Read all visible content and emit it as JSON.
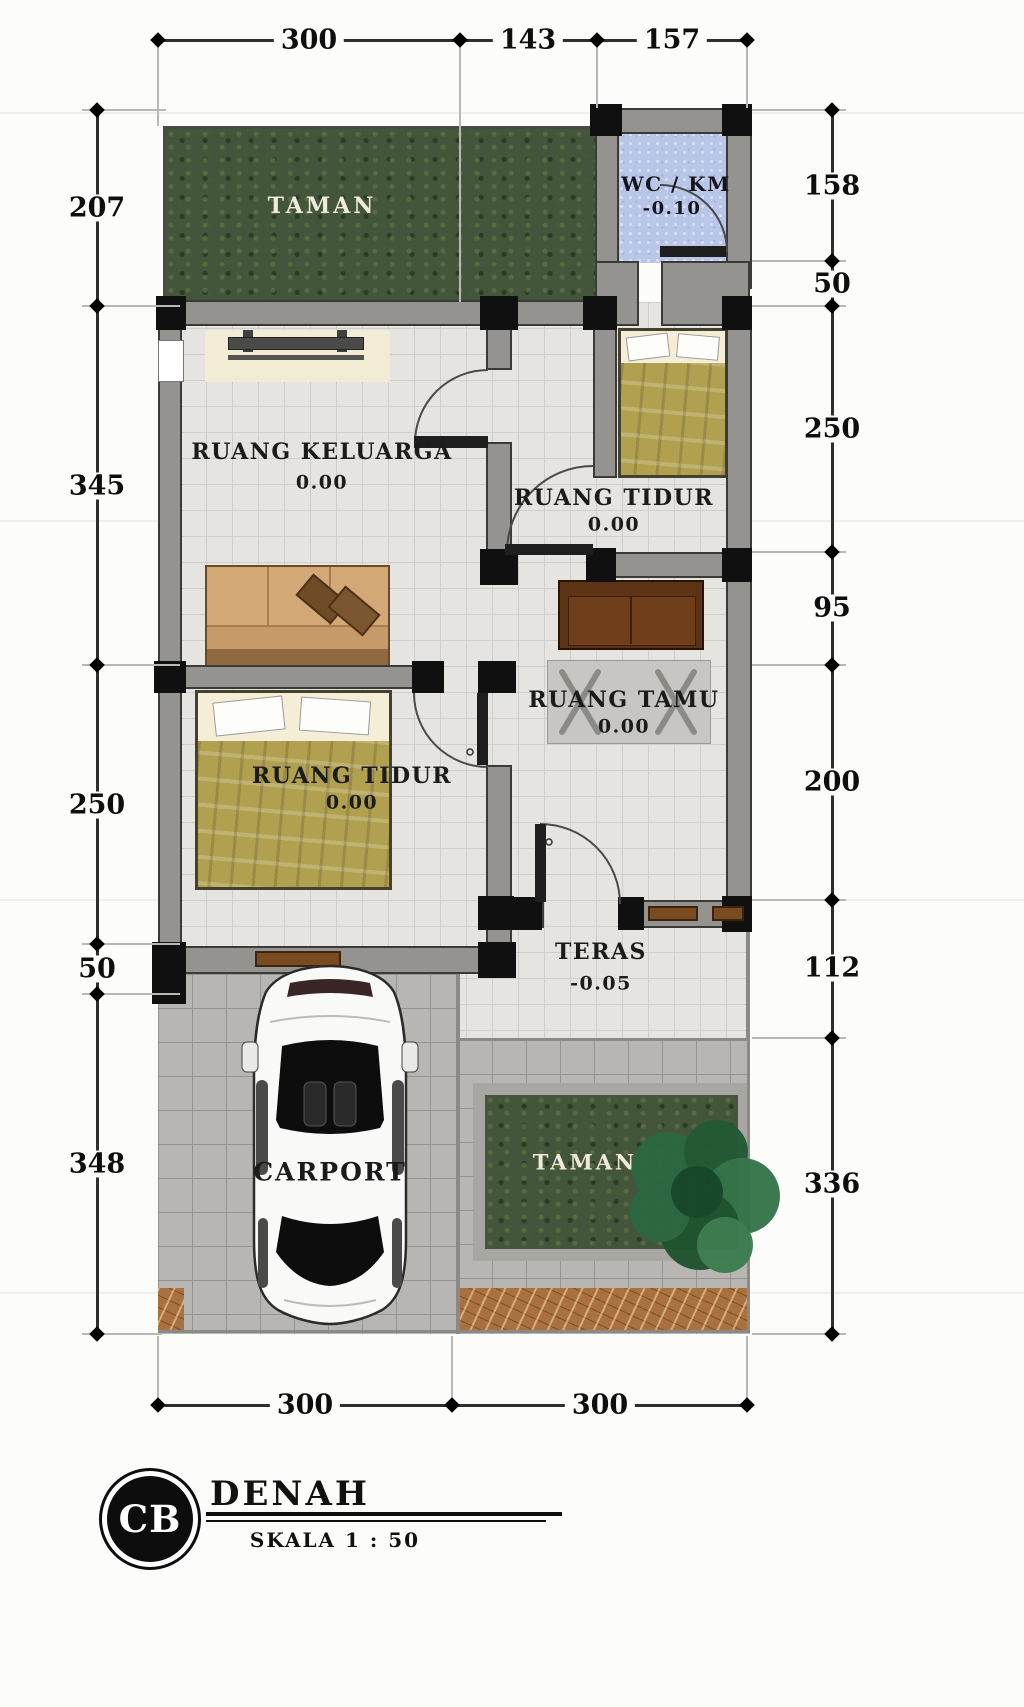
{
  "footer": {
    "logo": "CB",
    "title": "DENAH",
    "scale": "SKALA 1 : 50"
  },
  "dimensions": {
    "top": [
      "300",
      "143",
      "157"
    ],
    "bottom": [
      "300",
      "300"
    ],
    "left": [
      "207",
      "345",
      "250",
      "50",
      "348"
    ],
    "right": [
      "158",
      "50",
      "250",
      "95",
      "200",
      "112",
      "336"
    ]
  },
  "rooms": {
    "taman_atas": {
      "name": "TAMAN"
    },
    "wc": {
      "name": "WC / KM",
      "level": "-0.10"
    },
    "ruang_keluarga": {
      "name": "RUANG KELUARGA",
      "level": "0.00"
    },
    "ruang_tidur_kanan": {
      "name": "RUANG TIDUR",
      "level": "0.00"
    },
    "ruang_tamu": {
      "name": "RUANG TAMU",
      "level": "0.00"
    },
    "ruang_tidur_kiri": {
      "name": "RUANG TIDUR",
      "level": "0.00"
    },
    "teras": {
      "name": "TERAS",
      "level": "-0.05"
    },
    "carport": {
      "name": "CARPORT"
    },
    "taman_bawah": {
      "name": "TAMAN"
    }
  },
  "colors": {
    "wall": "#95938f",
    "floor": "#e5e4e1",
    "wc_tile": "#bac6e8",
    "grass": "#43553a",
    "bed_cover": "#b0a04f",
    "wood": "#c79a6a",
    "sofa": "#5c3315",
    "paving": "#b8b6b3",
    "marble": "#a9713f"
  }
}
